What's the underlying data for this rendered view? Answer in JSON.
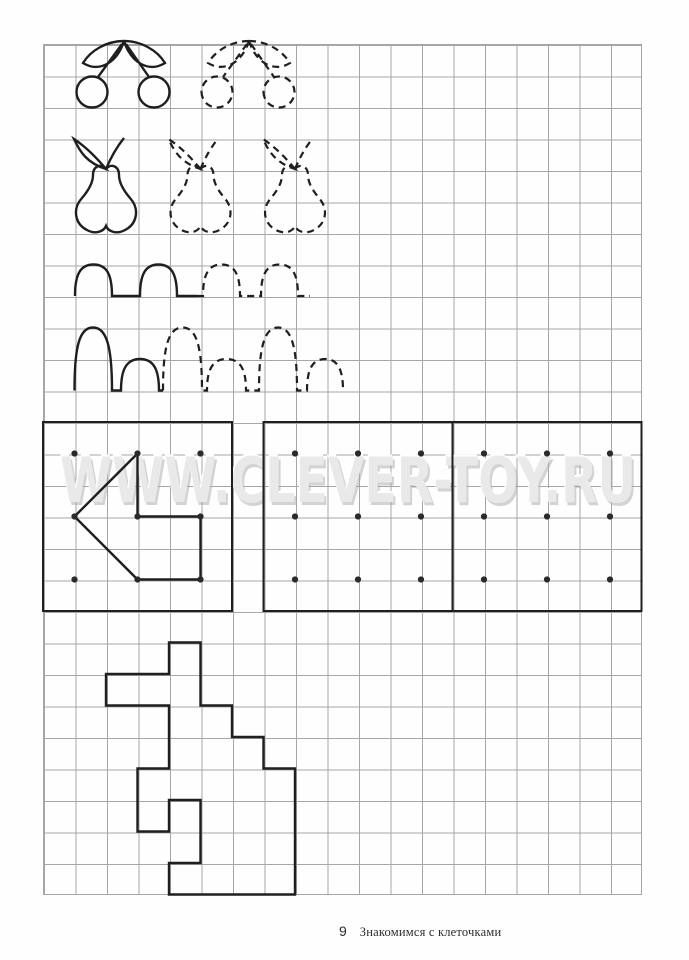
{
  "page": {
    "number": "9",
    "caption": "Знакомимся с клеточками",
    "watermark": "WWW.CLEVER-TOY.RU",
    "ink": "#1f1f1f",
    "grid": {
      "left": 43,
      "top": 44,
      "cell": 31.5,
      "cols": 19,
      "rows": 27,
      "line_color": "#a6a6a6"
    }
  },
  "drawings": {
    "dash_pattern": "7 5",
    "shapes": {
      "cherry": "M124,41 C107,41 91,50 83,63 C99,73 117,63 124,41 M124,41 C141,41 157,50 165,63 C149,73 131,63 124,41 M122,44 L98,77 M126,44 L149,77 M76.5,92 A15.5,15.5 0 1 0 107.5,92 A15.5,15.5 0 1 0 76.5,92 M138.5,92 A15.5,15.5 0 1 0 169.5,92 A15.5,15.5 0 1 0 138.5,92",
      "pear": "M106,169 C101,163 93,166 93,175 C93,183 88,191 82,198 C72,209 75,224 87,230 C96,235 104,231 106,226 C108,231 116,235 125,230 C137,224 140,209 130,198 C124,191 119,183 119,175 C119,166 111,163 106,169 Z M106,169 C96,157 86,147 74,139 C80,152 87,163 106,169 Z M106,169 C111,157 116,148 124,138",
      "wave1_solid": "M75,296 C75,275 80,264.5 93.5,264.5 C107,264.5 112,275 112,296 L140,296 C140,275 145,264.5 158.5,264.5 C172,264.5 177,275 177,296 L197,296",
      "wave1_dashed": "M197,296 L203,296 C203,275 208,264.5 221.5,264.5 C235,264.5 240,275 240,296 L261,296 C261,275 266,264.5 279.5,264.5 C293,264.5 298,275 298,296 L310,296",
      "wave2_solid": "M74.5,390.5 C74.5,348 79,327.5 93,327.5 C107,327.5 112,348 112,390.5 L121,390.5 C121,372 125,359 140,359 C155,359 159,372 159,390.5 L163,390.5",
      "wave2_dashed": "M163,390.5 C163,348 168,327.5 182.5,327.5 C197,327.5 202,348 202,390.5 L207,390.5 C207,372 211,359 226.5,359 C242,359 246,372 246,390.5 L259,390.5 C259,348 264,327.5 278,327.5 C292,327.5 297,348 297,390.5 L307,390.5 C307,372 311,359 325,359 C339,359 343,372 343,390.5",
      "arrow": "M74.5,516.5 L137.5,453.5 L137.5,516.5 L200.5,516.5 L200.5,579.5 L137.5,579.5 Z"
    },
    "instances": [
      {
        "name": "cherries-solid",
        "shape": "cherry",
        "dx": 0,
        "dashed": false
      },
      {
        "name": "cherries-traced",
        "shape": "cherry",
        "dx": 125,
        "dashed": true
      },
      {
        "name": "pear-solid",
        "shape": "pear",
        "dx": 0,
        "dashed": false
      },
      {
        "name": "pear-traced-1",
        "shape": "pear",
        "dx": 94.5,
        "dashed": true
      },
      {
        "name": "pear-traced-2",
        "shape": "pear",
        "dx": 189,
        "dashed": true
      },
      {
        "name": "wave-row1-solid",
        "shape": "wave1_solid",
        "dx": 0,
        "dashed": false
      },
      {
        "name": "wave-row1-traced",
        "shape": "wave1_dashed",
        "dx": 0,
        "dashed": true
      },
      {
        "name": "wave-row2-solid",
        "shape": "wave2_solid",
        "dx": 0,
        "dashed": false
      },
      {
        "name": "wave-row2-traced",
        "shape": "wave2_dashed",
        "dx": 0,
        "dashed": true
      },
      {
        "name": "arrow-sample",
        "shape": "arrow",
        "dx": 0,
        "dashed": false
      }
    ],
    "boxes": [
      {
        "name": "dot-box-1",
        "x": 43,
        "y": 422,
        "w": 189,
        "h": 189
      },
      {
        "name": "dot-box-2",
        "x": 263.5,
        "y": 422,
        "w": 189,
        "h": 189
      },
      {
        "name": "dot-box-3",
        "x": 452.5,
        "y": 422,
        "w": 189,
        "h": 189
      }
    ],
    "dots": {
      "r": 3.1,
      "rows_y": [
        453.5,
        516.5,
        579.5
      ],
      "groups": [
        [
          74.5,
          137.5,
          200.5
        ],
        [
          295,
          358,
          421
        ],
        [
          484,
          547,
          610
        ]
      ]
    },
    "step_figure": {
      "name": "step-figure",
      "cells": [
        [
          4,
          19
        ],
        [
          5,
          19
        ],
        [
          5,
          21
        ],
        [
          6,
          21
        ],
        [
          6,
          22
        ],
        [
          7,
          22
        ],
        [
          7,
          23
        ],
        [
          8,
          23
        ],
        [
          8,
          27
        ],
        [
          4,
          27
        ],
        [
          4,
          26
        ],
        [
          5,
          26
        ],
        [
          5,
          24
        ],
        [
          4,
          24
        ],
        [
          4,
          25
        ],
        [
          3,
          25
        ],
        [
          3,
          23
        ],
        [
          4,
          23
        ],
        [
          4,
          21
        ],
        [
          2,
          21
        ],
        [
          2,
          20
        ],
        [
          4,
          20
        ]
      ]
    }
  }
}
